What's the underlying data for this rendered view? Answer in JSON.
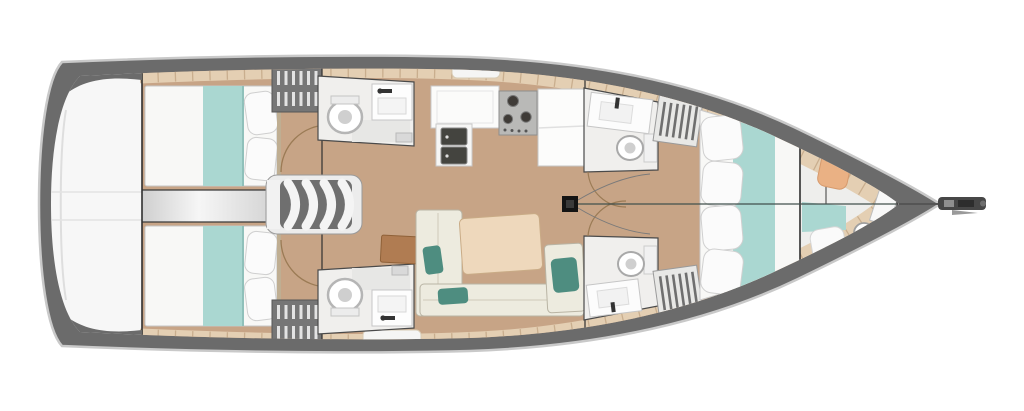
{
  "title": "Sailing yacht interior layout floor plan, top view, bow pointing right",
  "diagram_type": "boat-floor-plan",
  "orientation": "bow-right",
  "colors": {
    "background": "#ffffff",
    "hull_band_gray": "#6b6b6b",
    "hull_white": "#f7f7f7",
    "deck_plank_beige": "#e4cfb3",
    "plank_seam": "#c9ae8e",
    "floor_wood_tan": "#c7a486",
    "corridor_gray": "#d9d9d9",
    "bed_white": "#f8f8f6",
    "bed_runner_teal": "#aad7d1",
    "cushion_teal": "#4e8d80",
    "sofa_offwhite": "#edebdf",
    "table_tan": "#eed8bc",
    "desk_brown": "#b07c52",
    "locker_dark_gray": "#767676",
    "fixture_white": "#fdfdfd",
    "sink_basin_dark": "#44443f",
    "stove_gray": "#b9b9b7",
    "mast_black": "#141414",
    "forepeak_cushion_orange": "#eab184",
    "wall_line": "#2f2f2f",
    "door_arc": "#9b7b55"
  },
  "rooms": {
    "swim_platform": {
      "name": "transom swim platform",
      "features": [
        "bathing platform",
        "transom door lines"
      ]
    },
    "aft_cabin_port": {
      "name": "aft cabin port",
      "features": [
        "double bed",
        "teal bed runner",
        "two pillows",
        "hanging locker",
        "door swing arc"
      ]
    },
    "aft_cabin_starboard": {
      "name": "aft cabin starboard",
      "features": [
        "double bed",
        "teal bed runner",
        "two pillows",
        "hanging locker",
        "door swing arc"
      ]
    },
    "engine_passage": {
      "name": "engine compartment passage",
      "features": [
        "gray corridor between aft cabins"
      ]
    },
    "companionway": {
      "name": "companionway stairs",
      "features": [
        "four curved treads"
      ]
    },
    "aft_head_port": {
      "name": "aft head port",
      "features": [
        "toilet",
        "sink with faucet",
        "shower"
      ]
    },
    "aft_head_starboard": {
      "name": "aft head starboard",
      "features": [
        "toilet",
        "sink with faucet",
        "shower"
      ]
    },
    "galley": {
      "name": "galley",
      "features": [
        "L-shaped counter",
        "double sink",
        "three-burner stove",
        "fridge counter"
      ]
    },
    "saloon": {
      "name": "saloon",
      "features": [
        "L-shaped sofa",
        "dining table",
        "teal cushions",
        "chart desk"
      ]
    },
    "fwd_head_port": {
      "name": "forward head port",
      "features": [
        "sink",
        "toilet",
        "hanging locker",
        "door swing arc"
      ]
    },
    "fwd_head_starboard": {
      "name": "forward head starboard",
      "features": [
        "sink",
        "toilet",
        "hanging locker",
        "door swing arc"
      ]
    },
    "forward_cabin": {
      "name": "forward owner cabin",
      "features": [
        "island double bed",
        "teal runner",
        "four pillows",
        "entry bulkhead"
      ]
    },
    "forepeak": {
      "name": "forepeak crew compartment",
      "features": [
        "berth",
        "orange cushion",
        "white cushion",
        "teal cushion",
        "toilet",
        "small sink"
      ]
    },
    "bow": {
      "name": "bow",
      "features": [
        "bowsprit",
        "anchor roller",
        "rig centerline"
      ]
    },
    "mast": {
      "name": "mast base",
      "features": [
        "black mast step",
        "halyard lines"
      ]
    }
  }
}
